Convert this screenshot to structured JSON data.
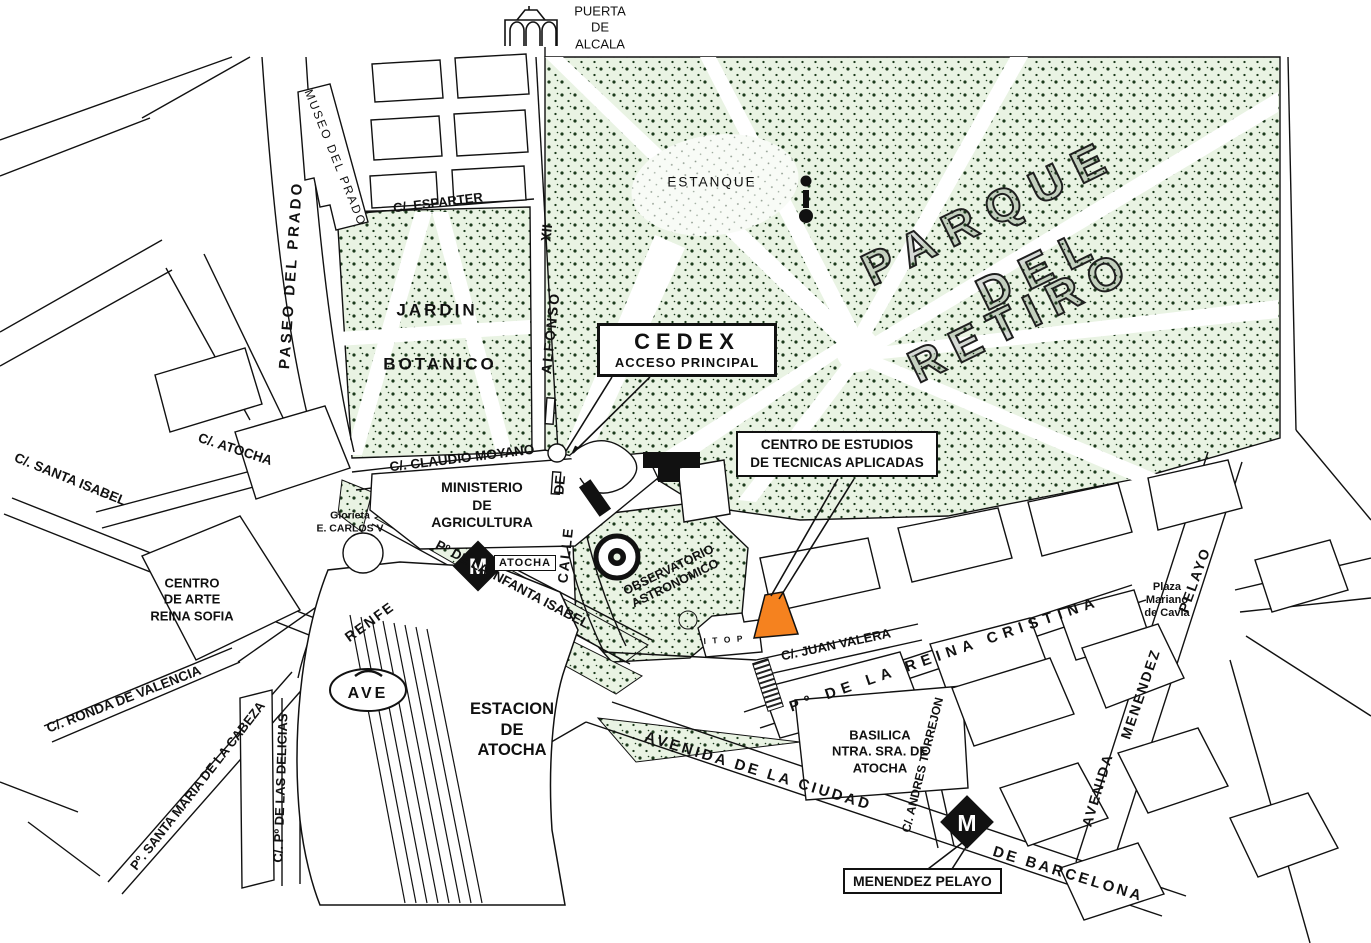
{
  "map": {
    "colors": {
      "park_fill": "#e9f3e3",
      "park_dot": "#1c3a1c",
      "highlight_orange": "#f5821f",
      "ink": "#111111",
      "water_fill": "#f6faf4"
    },
    "parks": {
      "retiro_line1": "PARQUE",
      "retiro_line2": "DEL",
      "retiro_line3": "RETIRO",
      "estanque": "ESTANQUE",
      "jardin": "JARDIN",
      "botanico": "BOTANICO"
    },
    "landmarks": {
      "puerta_de_alcala": "PUERTA\nDE\nALCALA",
      "museo_del_prado": "MUSEO  DEL  PRADO",
      "ministerio": "MINISTERIO\nDE\nAGRICULTURA",
      "glorieta": "Glorieta\nE. CARLOS V",
      "reina_sofia": "CENTRO\nDE ARTE\nREINA SOFIA",
      "estacion": "ESTACION\nDE\nATOCHA",
      "renfe": "RENFE",
      "ave": "AVE",
      "observatorio": "OBSERVATORIO\nASTRONOMICO",
      "basilica": "BASILICA\nNTRA. SRA. DE\nATOCHA",
      "plaza_mariano": "Plaza\nMariano\nde Cavia",
      "itop": "I T O P",
      "metro_m": "M"
    },
    "callouts": {
      "cedex_title": "CEDEX",
      "cedex_sub": "ACCESO    PRINCIPAL",
      "centro_estudios": "CENTRO DE ESTUDIOS\nDE TECNICAS APLICADAS",
      "menendez_pelayo": "MENENDEZ PELAYO",
      "atocha_metro": "ATOCHA"
    },
    "streets": {
      "paseo_del_prado": "PASEO  DEL  PRADO",
      "esparter": "C/.   ESPARTER",
      "calle": "CALLE",
      "de": "DE",
      "alfonso": "ALFONSO",
      "xii": "XII",
      "claudio_moyano": "C/.  CLAUDIO  MOYANO",
      "atocha": "C/.   ATOCHA",
      "santa_isabel": "C/.  SANTA  ISABEL",
      "ronda_valencia": "C/.  RONDA DE VALENCIA",
      "santa_maria": "Pº.  SANTA  MARIA  DE  LA  CABEZA",
      "delicias": "C/.  Pº  DE  LAS  DELICIAS",
      "infanta_isabel": "Pº  DE  LA  INFANTA  ISABEL",
      "juan_valera": "C/.  JUAN  VALERA",
      "reina_cristina": "Pº   DE   LA   REINA   CRISTINA",
      "andres_torrejon": "C/. ANDRES TORREJON",
      "avenida_ciudad": "AVENIDA   DE   LA   CIUDAD",
      "de_barcelona": "DE   BARCELONA",
      "pelayo": "PELAYO",
      "menendez": "MENENDEZ",
      "avenida": "AVENIDA"
    }
  }
}
